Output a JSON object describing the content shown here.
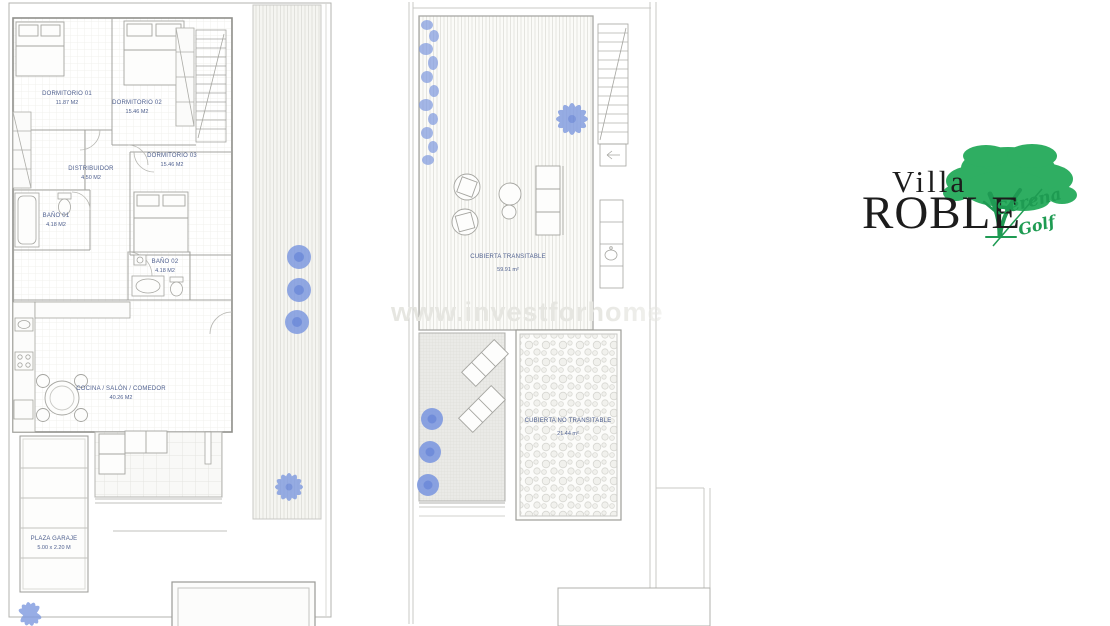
{
  "watermark": {
    "text": "www.investforhome"
  },
  "logo": {
    "villa": "Villa",
    "roble": "ROBLE",
    "serena": "Serena",
    "golf": "Golf"
  },
  "ground_floor": {
    "dormitorio1": {
      "name": "DORMITORIO 01",
      "area": "11.87 M2"
    },
    "dormitorio2": {
      "name": "DORMITORIO 02",
      "area": "15.46 M2"
    },
    "dormitorio3": {
      "name": "DORMITORIO 03",
      "area": "15.46 M2"
    },
    "distribuidor": {
      "name": "DISTRIBUIDOR",
      "area": "4.50 M2"
    },
    "bano1": {
      "name": "BAÑO 01",
      "area": "4.18 M2"
    },
    "bano2": {
      "name": "BAÑO 02",
      "area": "4.18 M2"
    },
    "cocina": {
      "name": "COCINA / SALÓN / COMEDOR",
      "area": "40.26 M2"
    },
    "garaje": {
      "name": "PLAZA GARAJE",
      "area": "5.00 x 2.20 M"
    }
  },
  "roof": {
    "transitable": {
      "name": "CUBIERTA TRANSITABLE",
      "area": "59.91 m²"
    },
    "no_transitable": {
      "name": "CUBIERTA NO TRANSITABLE",
      "area": "21.44 m²"
    }
  },
  "colors": {
    "plant_blue": "#7e99df",
    "plant_blue_dark": "#5f7fd6",
    "label_blue": "#4e5f8e",
    "logo_green": "#2fae62",
    "script_green": "#1e9b52"
  }
}
